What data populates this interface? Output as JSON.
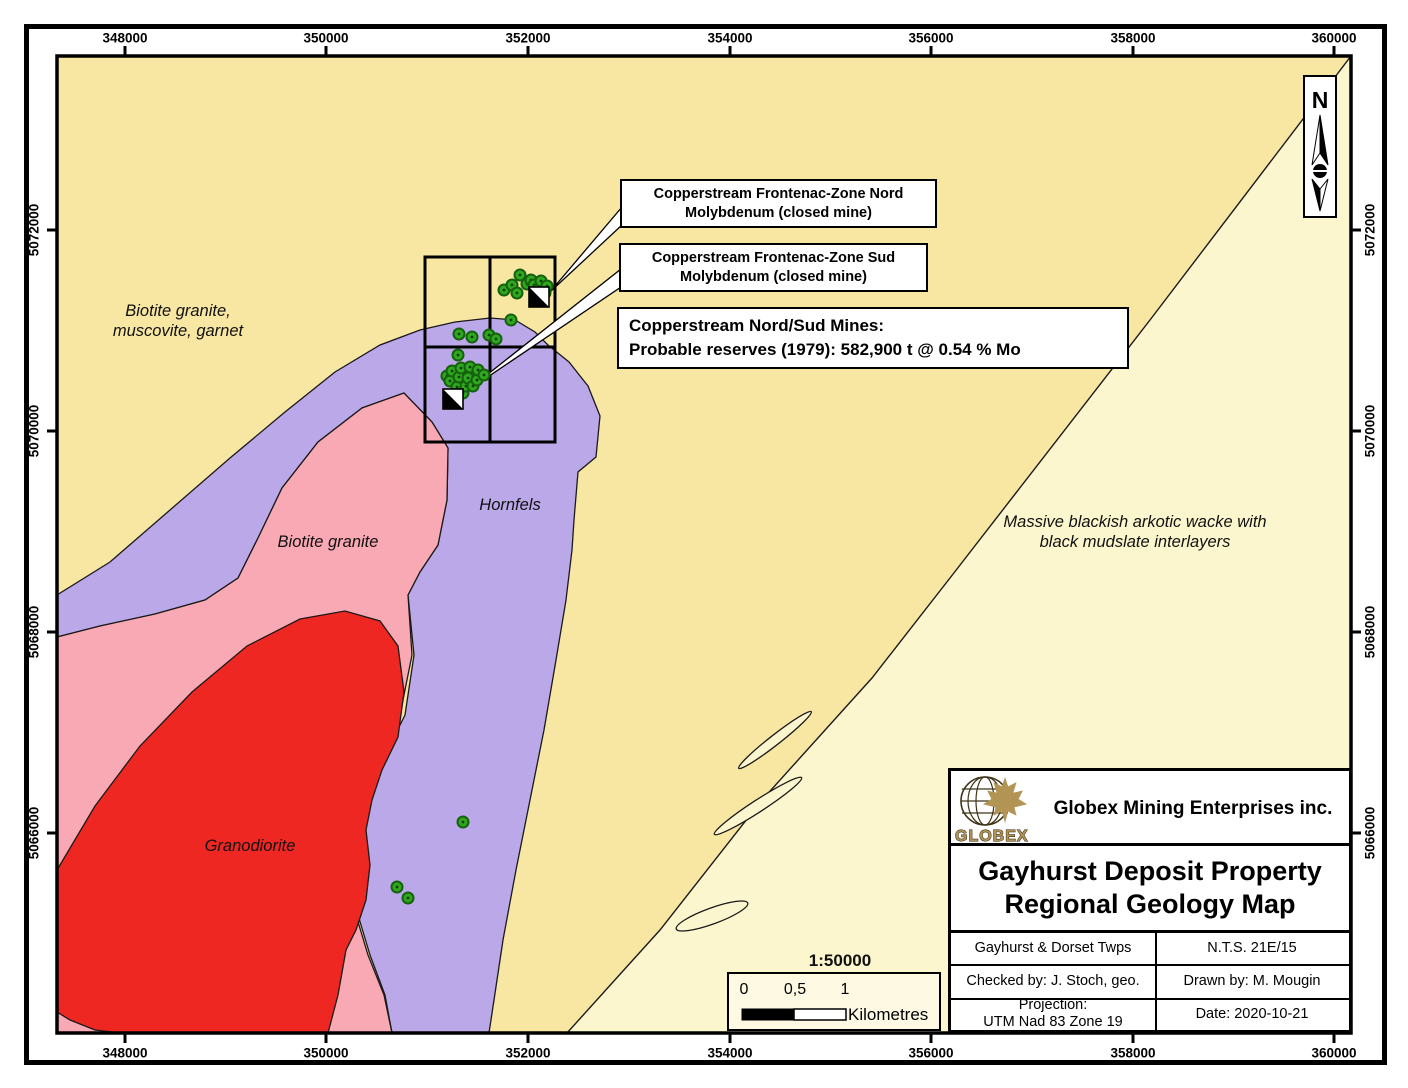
{
  "legend": {
    "granite_muscovite_garnet": "#F8E7A2",
    "wacke": "#FCF6CE",
    "hornfels": "#BBA8E8",
    "biotite_granite": "#F8A9B4",
    "granodiorite": "#EE2722",
    "occurrence_fill": "#2FA71E",
    "occurrence_ring": "#15610D",
    "occurrence_center": "#0B3D06",
    "logo_gold": "#B29455",
    "frame_black": "#000000"
  },
  "axes": {
    "top": {
      "labels": [
        "348000",
        "350000",
        "352000",
        "354000",
        "356000",
        "358000",
        "360000"
      ],
      "x": [
        125,
        326,
        528,
        730,
        931,
        1133,
        1334
      ]
    },
    "bottom": {
      "labels": [
        "348000",
        "350000",
        "352000",
        "354000",
        "356000",
        "358000",
        "360000"
      ],
      "x": [
        125,
        326,
        528,
        730,
        931,
        1133,
        1334
      ]
    },
    "left": {
      "labels": [
        "5072000",
        "5070000",
        "5068000",
        "5066000"
      ],
      "y": [
        230,
        431,
        632,
        833
      ]
    },
    "right": {
      "labels": [
        "5072000",
        "5070000",
        "5068000",
        "5066000"
      ],
      "y": [
        230,
        431,
        632,
        833
      ]
    }
  },
  "region_labels": [
    {
      "line1": "Biotite granite,",
      "line2": "muscovite, garnet",
      "x": 178,
      "y": 321
    },
    {
      "line1": "Biotite granite",
      "line2": "",
      "x": 328,
      "y": 542
    },
    {
      "line1": "Hornfels",
      "line2": "",
      "x": 510,
      "y": 505
    },
    {
      "line1": "Granodiorite",
      "line2": "",
      "x": 250,
      "y": 846
    },
    {
      "line1": "Massive blackish arkotic wacke with",
      "line2": "black mudslate interlayers",
      "x": 1135,
      "y": 532
    }
  ],
  "callouts": {
    "nord": {
      "line1": "Copperstream Frontenac-Zone Nord",
      "line2": "Molybdenum (closed mine)"
    },
    "sud": {
      "line1": "Copperstream Frontenac-Zone Sud",
      "line2": "Molybdenum (closed mine)"
    },
    "reserves": {
      "line1": "Copperstream Nord/Sud Mines:",
      "line2": "Probable reserves (1979): 582,900 t @ 0.54 % Mo"
    }
  },
  "north_label": "N",
  "scale_bar": {
    "ratio": "1:50000",
    "tick0": "0",
    "tick05": "0,5",
    "tick1": "1",
    "unit": "Kilometres"
  },
  "title_block": {
    "logo_text": "GLOBEX",
    "company": "Globex Mining Enterprises inc.",
    "title_line1": "Gayhurst Deposit Property",
    "title_line2": "Regional Geology Map",
    "township": "Gayhurst & Dorset Twps",
    "nts": "N.T.S. 21E/15",
    "checked_by": "Checked by: J. Stoch, geo.",
    "drawn_by": "Drawn by: M. Mougin",
    "projection_label": "Projection:",
    "projection_value": "UTM Nad 83 Zone 19",
    "date": "Date: 2020-10-21"
  },
  "occurrences": [
    [
      504,
      290
    ],
    [
      512,
      285
    ],
    [
      517,
      293
    ],
    [
      520,
      275
    ],
    [
      527,
      284
    ],
    [
      531,
      280
    ],
    [
      534,
      285
    ],
    [
      538,
      290
    ],
    [
      541,
      281
    ],
    [
      547,
      286
    ],
    [
      545,
      293
    ],
    [
      511,
      320
    ],
    [
      459,
      334
    ],
    [
      472,
      337
    ],
    [
      489,
      335
    ],
    [
      496,
      339
    ],
    [
      458,
      355
    ],
    [
      447,
      376
    ],
    [
      450,
      381
    ],
    [
      452,
      371
    ],
    [
      455,
      395
    ],
    [
      457,
      387
    ],
    [
      459,
      377
    ],
    [
      461,
      368
    ],
    [
      463,
      393
    ],
    [
      466,
      386
    ],
    [
      468,
      378
    ],
    [
      470,
      367
    ],
    [
      473,
      386
    ],
    [
      477,
      380
    ],
    [
      478,
      370
    ],
    [
      484,
      375
    ],
    [
      463,
      822
    ],
    [
      397,
      887
    ],
    [
      408,
      898
    ]
  ],
  "mines": [
    {
      "x": 529,
      "y": 287,
      "size": 20
    },
    {
      "x": 443,
      "y": 389,
      "size": 20
    }
  ]
}
